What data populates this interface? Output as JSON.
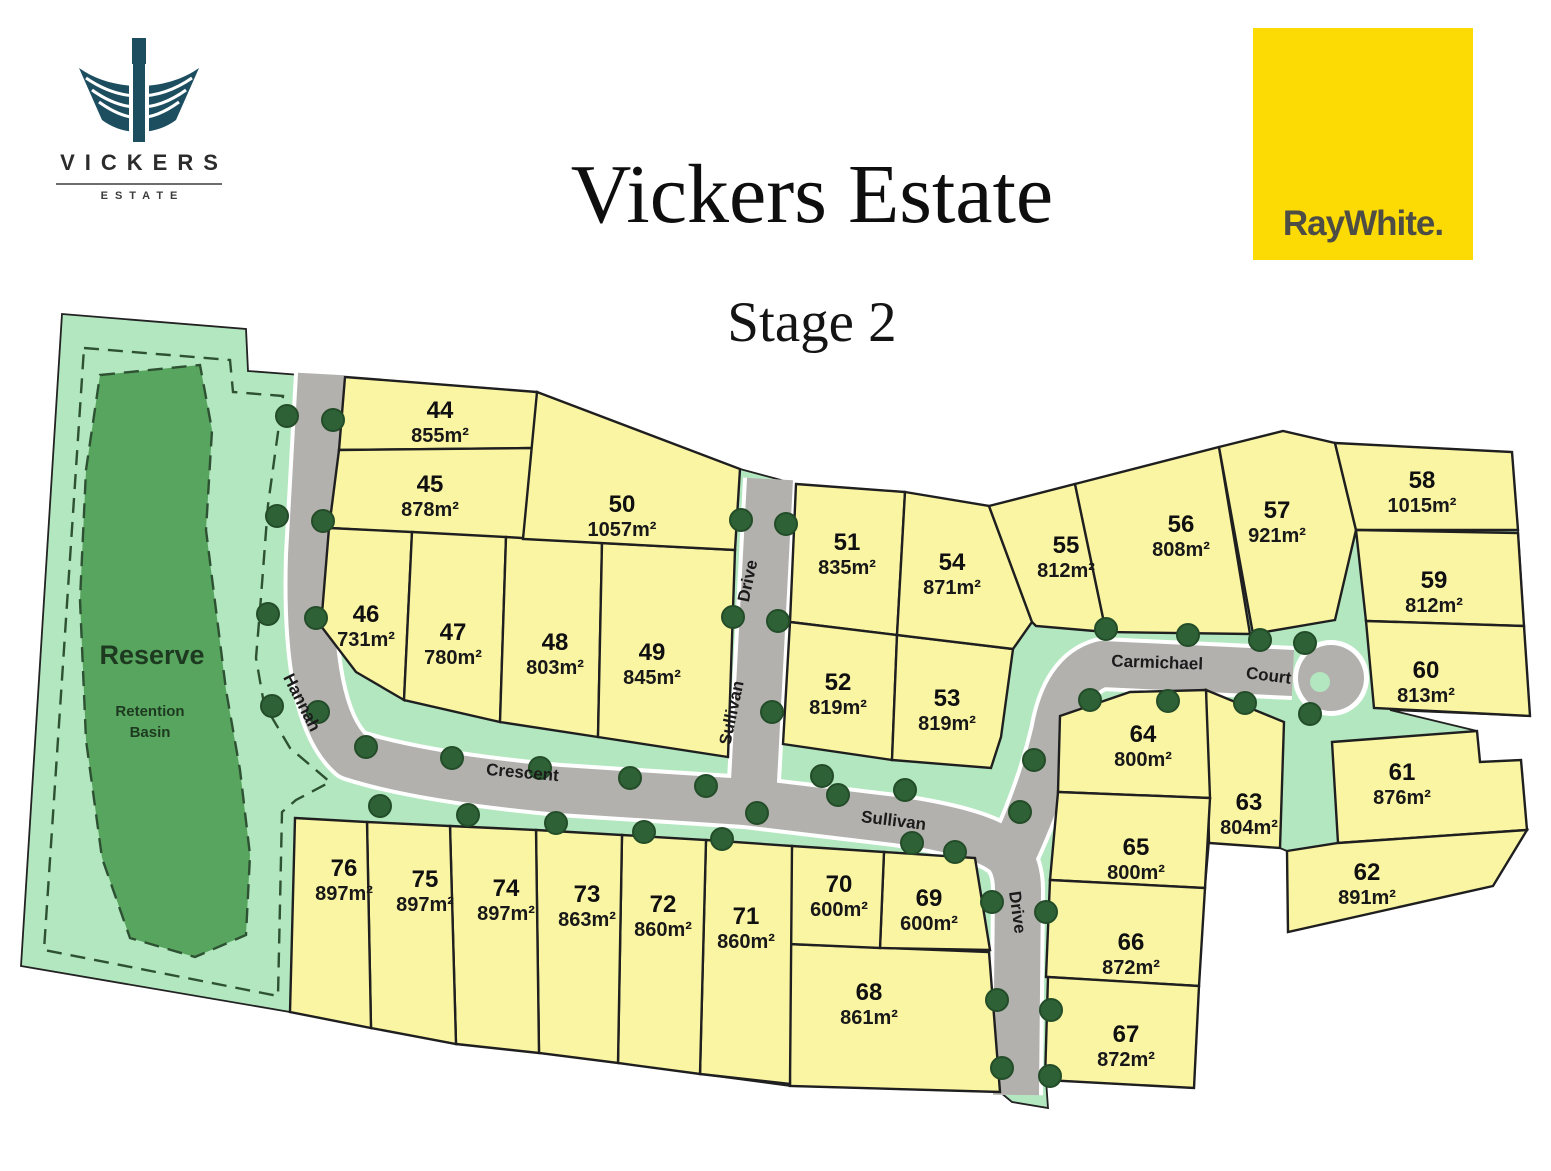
{
  "branding": {
    "vickers_logo": {
      "name": "VICKERS",
      "tagline": "ESTATE"
    },
    "agency_logo": {
      "text": "RayWhite.",
      "background": "#fcdb05"
    }
  },
  "header": {
    "title": "Vickers Estate",
    "subtitle": "Stage 2"
  },
  "map": {
    "reserve": {
      "title": "Reserve",
      "subtitle_line1": "Retention",
      "subtitle_line2": "Basin"
    },
    "streets": [
      {
        "id": "hannah",
        "label": "Hannah"
      },
      {
        "id": "crescent",
        "label": "Crescent"
      },
      {
        "id": "sullivan-north",
        "label": "Sullivan"
      },
      {
        "id": "drive-north",
        "label": "Drive"
      },
      {
        "id": "sullivan-east",
        "label": "Sullivan"
      },
      {
        "id": "drive-south",
        "label": "Drive"
      },
      {
        "id": "carmichael",
        "label": "Carmichael"
      },
      {
        "id": "court",
        "label": "Court"
      }
    ],
    "lots": [
      {
        "number": "44",
        "area": "855m²"
      },
      {
        "number": "45",
        "area": "878m²"
      },
      {
        "number": "46",
        "area": "731m²"
      },
      {
        "number": "47",
        "area": "780m²"
      },
      {
        "number": "48",
        "area": "803m²"
      },
      {
        "number": "49",
        "area": "845m²"
      },
      {
        "number": "50",
        "area": "1057m²"
      },
      {
        "number": "51",
        "area": "835m²"
      },
      {
        "number": "52",
        "area": "819m²"
      },
      {
        "number": "53",
        "area": "819m²"
      },
      {
        "number": "54",
        "area": "871m²"
      },
      {
        "number": "55",
        "area": "812m²"
      },
      {
        "number": "56",
        "area": "808m²"
      },
      {
        "number": "57",
        "area": "921m²"
      },
      {
        "number": "58",
        "area": "1015m²"
      },
      {
        "number": "59",
        "area": "812m²"
      },
      {
        "number": "60",
        "area": "813m²"
      },
      {
        "number": "61",
        "area": "876m²"
      },
      {
        "number": "62",
        "area": "891m²"
      },
      {
        "number": "63",
        "area": "804m²"
      },
      {
        "number": "64",
        "area": "800m²"
      },
      {
        "number": "65",
        "area": "800m²"
      },
      {
        "number": "66",
        "area": "872m²"
      },
      {
        "number": "67",
        "area": "872m²"
      },
      {
        "number": "68",
        "area": "861m²"
      },
      {
        "number": "69",
        "area": "600m²"
      },
      {
        "number": "70",
        "area": "600m²"
      },
      {
        "number": "71",
        "area": "860m²"
      },
      {
        "number": "72",
        "area": "860m²"
      },
      {
        "number": "73",
        "area": "863m²"
      },
      {
        "number": "74",
        "area": "897m²"
      },
      {
        "number": "75",
        "area": "897m²"
      },
      {
        "number": "76",
        "area": "897m²"
      }
    ],
    "colors": {
      "lot_fill": "#faf5a3",
      "verge_green": "#b2e7bf",
      "basin_green": "#58a55f",
      "road_grey": "#b3b1ae",
      "tree_green": "#2f6136",
      "boundary_black": "#1f1f1f",
      "logo_teal": "#1d4e60"
    }
  }
}
